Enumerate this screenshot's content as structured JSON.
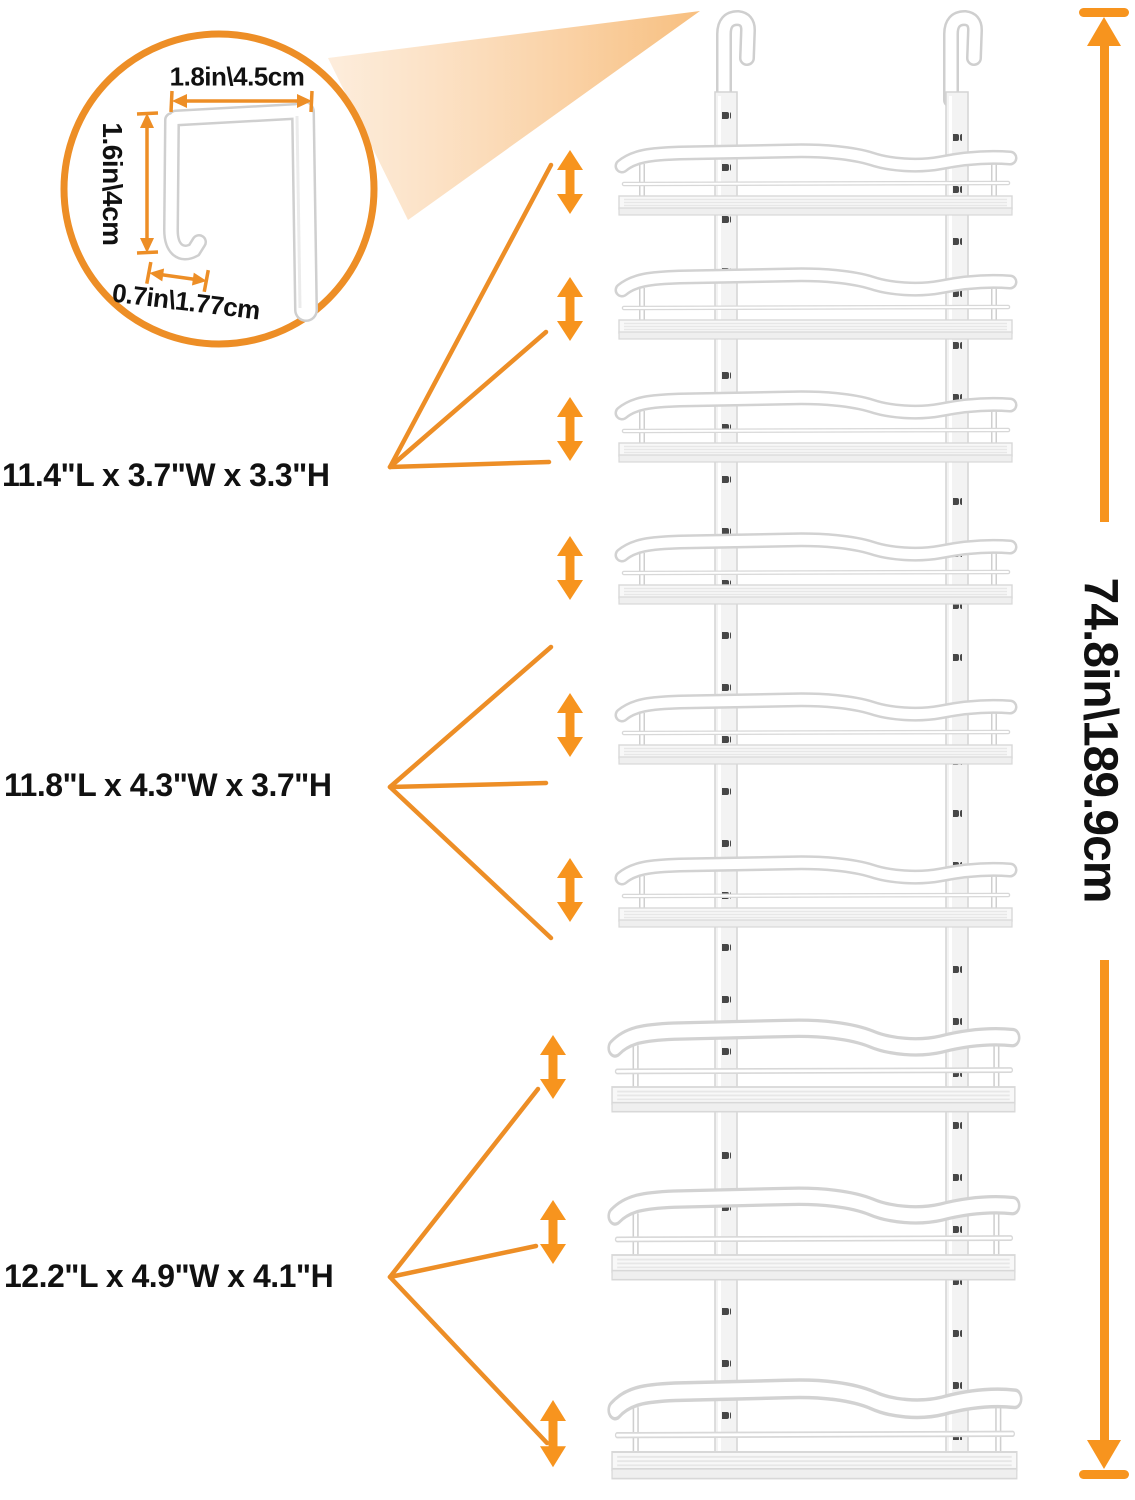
{
  "inset": {
    "width_label": "1.8in\\4.5cm",
    "height_label": "1.6in\\4cm",
    "thickness_label": "0.7in\\1.77cm"
  },
  "tier_labels": {
    "top": "11.4\"L x 3.7\"W x 3.3\"H",
    "middle": "11.8\"L x 4.3\"W x 3.7\"H",
    "bottom": "12.2\"L x 4.9\"W x 4.1\"H"
  },
  "overall_height_label": "74.8in\\189.9cm",
  "icons": {
    "adjust_arrow": "double-vertical-arrow-icon",
    "height_measure": "vertical-measure-arrow-icon",
    "door_hook": "over-door-hook-icon"
  },
  "colors": {
    "accent_orange": "#F7941E",
    "line_orange": "#ED8E26",
    "beam_light": "#F9C98C",
    "text": "#111111",
    "rack_edge": "#D2D2D2",
    "slot_dark": "#474747"
  }
}
